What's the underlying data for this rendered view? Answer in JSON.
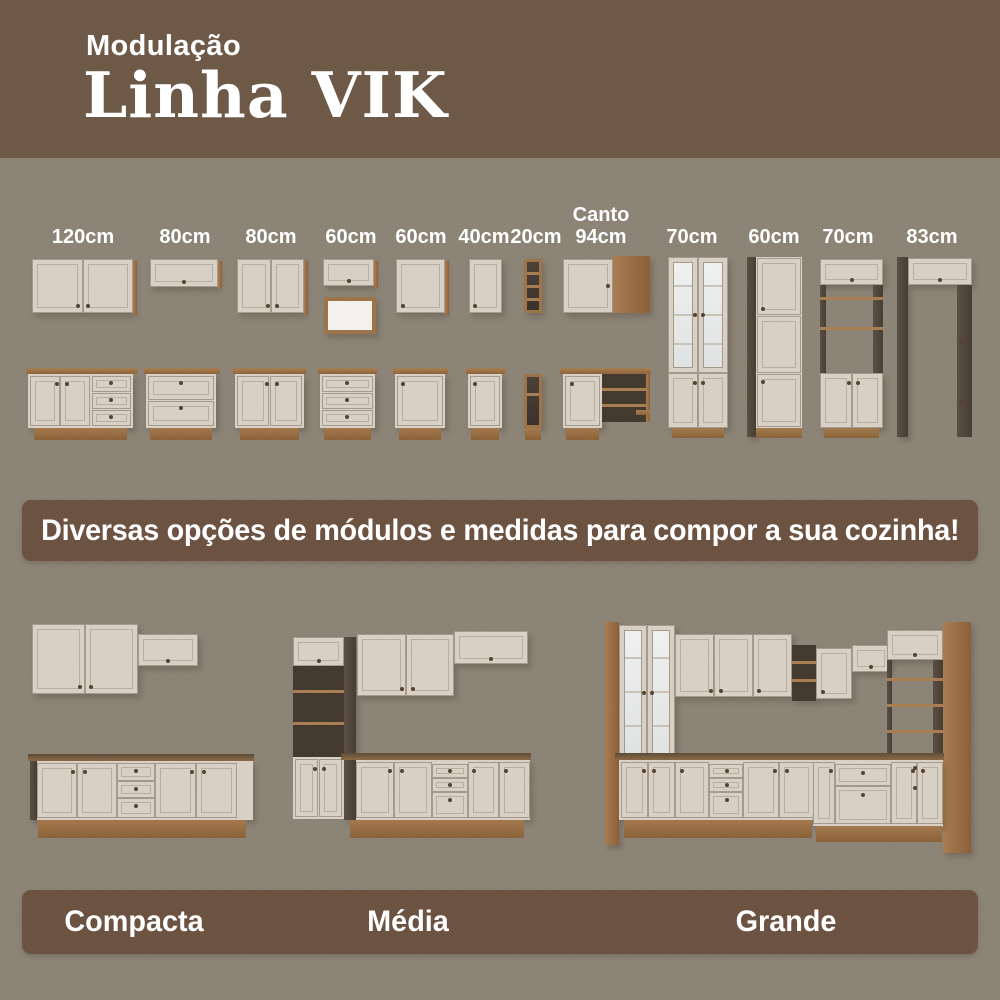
{
  "header": {
    "subtitle": "Modulação",
    "title": "Linha VIK"
  },
  "modules": [
    {
      "label": "120cm"
    },
    {
      "label": "80cm"
    },
    {
      "label": "80cm"
    },
    {
      "label": "60cm"
    },
    {
      "label": "60cm"
    },
    {
      "label": "40cm"
    },
    {
      "label": "20cm"
    },
    {
      "label_top": "Canto",
      "label": "94cm"
    },
    {
      "label": "70cm"
    },
    {
      "label": "60cm"
    },
    {
      "label": "70cm"
    },
    {
      "label": "83cm"
    }
  ],
  "banner": {
    "text": "Diversas opções de módulos e medidas para compor a sua cozinha!"
  },
  "kitchens": [
    {
      "label": "Compacta"
    },
    {
      "label": "Média"
    },
    {
      "label": "Grande"
    }
  ],
  "colors": {
    "header_bg": "#6d5846",
    "page_bg": "#8b8375",
    "banner_bg": "#6b5140",
    "cabinet_cream": "#d8d0c5",
    "wood": "#a87d52",
    "dark_wood": "#463c33",
    "text": "#ffffff"
  }
}
